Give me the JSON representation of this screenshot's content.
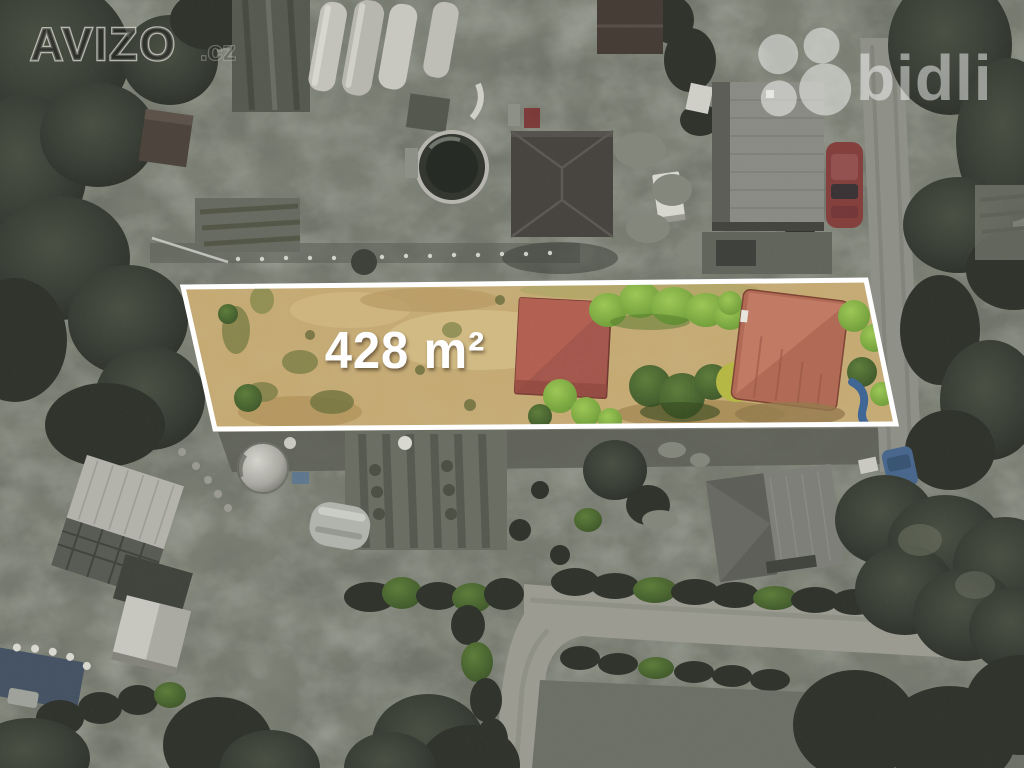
{
  "branding": {
    "avizo_watermark": {
      "text": "AVIZO",
      "suffix": ".cz",
      "style_color": "#d8d8d0"
    },
    "bidli_logo": {
      "text": "bidli",
      "icon": "clover-icon",
      "color": "#ffffff"
    }
  },
  "parcel": {
    "area_label": "428 m²",
    "outline_color": "#ffffff",
    "colors": {
      "dry_grass": "#c6aa73",
      "shed_roof": "#a4574d",
      "barn_roof": "#b06a55",
      "bright_hedge": "#83b144",
      "dark_bush": "#4c6e33",
      "yellow_bush": "#b6b845",
      "blue_slide": "#3f6695"
    }
  },
  "scene": {
    "presentation": "aerial drone photo; surroundings desaturated, listed parcel highlighted in color",
    "features": [
      "allotment gardens",
      "polytunnel greenhouses",
      "round above-ground pool",
      "hip-roof house",
      "gable-roof house",
      "red car",
      "blue car",
      "silver water tank",
      "garden sheds",
      "vegetable beds",
      "curving gravel road",
      "hedgerows",
      "large trees",
      "blue garden slide",
      "blue tarp"
    ]
  }
}
